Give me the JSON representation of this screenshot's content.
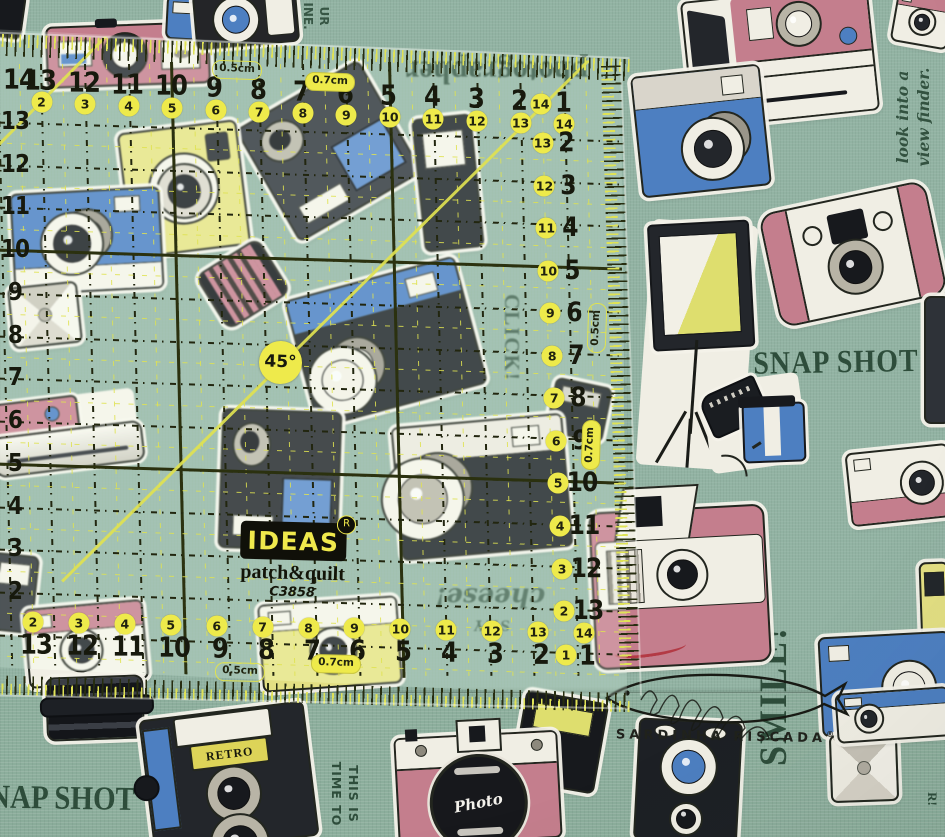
{
  "scene": {
    "subject": "Square transparent quilting ruler lying on sage-green vintage-camera print fabric",
    "photo": true
  },
  "palette": {
    "fabric_green": "#92b3a3",
    "fabric_green_bottom": "#8cae9c",
    "ruler_line_dark": "#2b310f",
    "ruler_dash_black": "#22260f",
    "ruler_accent_yellow": "#dfe250",
    "circle_yellow": "#eeea4b",
    "ink_green": "#2e4d3b",
    "ink_black": "#20221c",
    "sticker_white": "#f1efe6",
    "camera_pink": "#c47e8d",
    "camera_blue": "#4d7fc1",
    "camera_yellow": "#e3df83",
    "camera_dark": "#21242a"
  },
  "ruler": {
    "brand": {
      "name": "IDEAS",
      "reg": "R",
      "line2": "patch&quilt",
      "model": "C3858"
    },
    "angle_label": "45°",
    "labels": {
      "half": "0.5cm",
      "seven": "0.7cm"
    },
    "top_row": [
      {
        "b": "14"
      },
      {
        "b": "13",
        "y": "2"
      },
      {
        "b": "12",
        "y": "3"
      },
      {
        "b": "11",
        "y": "4"
      },
      {
        "b": "10",
        "y": "5"
      },
      {
        "b": "9",
        "y": "6"
      },
      {
        "b": "8",
        "y": "7"
      },
      {
        "b": "7",
        "y": "8"
      },
      {
        "b": "6",
        "y": "9"
      },
      {
        "b": "5",
        "y": "10"
      },
      {
        "b": "4",
        "y": "11"
      },
      {
        "b": "3",
        "y": "12"
      },
      {
        "b": "2",
        "y": "13"
      },
      {
        "b": "1",
        "y": "14"
      }
    ],
    "left_col": [
      "13",
      "12",
      "11",
      "10",
      "9",
      "8",
      "7",
      "6",
      "5",
      "4",
      "3",
      "2"
    ],
    "right_col": [
      {
        "y": "14"
      },
      {
        "b": "2",
        "y": "13"
      },
      {
        "b": "3",
        "y": "12"
      },
      {
        "b": "4",
        "y": "11"
      },
      {
        "b": "5",
        "y": "10"
      },
      {
        "b": "6",
        "y": "9"
      },
      {
        "b": "7",
        "y": "8"
      },
      {
        "b": "8",
        "y": "7"
      },
      {
        "b": "9",
        "y": "6"
      },
      {
        "b": "10",
        "y": "5"
      },
      {
        "b": "11",
        "y": "4"
      },
      {
        "b": "12",
        "y": "3"
      },
      {
        "b": "13",
        "y": "2"
      }
    ],
    "bottom_row": [
      {
        "b": "13",
        "y": "2"
      },
      {
        "b": "12",
        "y": "3"
      },
      {
        "b": "11",
        "y": "4"
      },
      {
        "b": "10",
        "y": "5"
      },
      {
        "b": "9",
        "y": "6"
      },
      {
        "b": "8",
        "y": "7"
      },
      {
        "b": "7",
        "y": "8"
      },
      {
        "b": "6",
        "y": "9"
      },
      {
        "b": "5",
        "y": "10"
      },
      {
        "b": "4",
        "y": "11"
      },
      {
        "b": "3",
        "y": "12"
      },
      {
        "b": "2",
        "y": "13"
      },
      {
        "b": "1",
        "y": "14"
      }
    ],
    "bottom_extra_yellow": "1"
  },
  "fabric_texts": [
    {
      "id": "photographer",
      "lines": [
        "photographer"
      ],
      "x": 497,
      "y": 72,
      "rot": 180,
      "size": 31,
      "cls": "serif",
      "sy": 1.05,
      "op": 0.88
    },
    {
      "id": "top-partial",
      "lines": [
        "UR",
        "INE."
      ],
      "x": 316,
      "y": 16,
      "rot": 90,
      "size": 12,
      "cls": "sans",
      "op": 0.9
    },
    {
      "id": "look-into-viewfinder",
      "lines": [
        "look into a",
        "view finder."
      ],
      "x": 914,
      "y": 117,
      "rot": -90,
      "size": 15.5,
      "cls": "script",
      "op": 0.95
    },
    {
      "id": "snap-shot",
      "lines": [
        "SNAP SHOT"
      ],
      "x": 836,
      "y": 363,
      "rot": -1,
      "size": 28,
      "cls": "serif",
      "sy": 1.15,
      "ls": 1
    },
    {
      "id": "click",
      "lines": [
        "CLICK!"
      ],
      "x": 512,
      "y": 338,
      "rot": 90,
      "size": 21,
      "cls": "serif",
      "ls": 2,
      "op": 0.8
    },
    {
      "id": "lets-take-a-photo",
      "lines": [
        "LET'S TAKE A",
        "PHOTO TOGETHER!"
      ],
      "x": 352,
      "y": 354,
      "rot": 180,
      "size": 11,
      "cls": "serif",
      "op": 0.78
    },
    {
      "id": "say-cheese",
      "lines": [
        "SAY",
        "cheese!"
      ],
      "x": 490,
      "y": 607,
      "rot": 180,
      "size": 16,
      "cls": "script",
      "op": 0.72,
      "big2": 26
    },
    {
      "id": "smile",
      "lines": [
        "SMILE!"
      ],
      "x": 773,
      "y": 696,
      "rot": -90,
      "size": 36,
      "cls": "serif",
      "sy": 1.1,
      "ls": 2
    },
    {
      "id": "this-is-time-to",
      "lines": [
        "THIS IS",
        "TIME TO"
      ],
      "x": 344,
      "y": 794,
      "rot": 90,
      "size": 12.5,
      "cls": "sans",
      "ls": 1
    },
    {
      "id": "nap-shot",
      "lines": [
        "NAP SHOT"
      ],
      "x": 62,
      "y": 799,
      "rot": 1,
      "size": 29,
      "cls": "serif",
      "sy": 1.15
    },
    {
      "id": "partial-r",
      "lines": [
        "R!"
      ],
      "x": 932,
      "y": 799,
      "rot": 90,
      "size": 13,
      "cls": "serif"
    }
  ],
  "stickers": [
    {
      "id": "black-corner-topleft",
      "type": "block",
      "x": -10,
      "y": -8,
      "w": 30,
      "h": 42,
      "rot": 8,
      "body": "#17191d"
    },
    {
      "id": "pink-rangefinder-top",
      "type": "rangefinder",
      "x": 46,
      "y": 24,
      "w": 160,
      "h": 58,
      "rot": -2,
      "body": "#c47e8d"
    },
    {
      "id": "blue-strip-top",
      "type": "block",
      "x": 166,
      "y": -4,
      "w": 36,
      "h": 40,
      "rot": 3,
      "body": "#4d7fc1",
      "band": "#f0eee4"
    },
    {
      "id": "tlr-topview",
      "type": "tlrtop",
      "x": 194,
      "y": -10,
      "w": 100,
      "h": 52,
      "rot": -5
    },
    {
      "id": "white-cam-topright",
      "type": "compact",
      "x": 894,
      "y": -10,
      "w": 54,
      "h": 52,
      "rot": 10,
      "body": "#f0eee4",
      "top": "#c47e8d",
      "lens": "#23262b",
      "lr": 12
    },
    {
      "id": "polaroid-camera",
      "type": "polaroid",
      "x": 686,
      "y": -8,
      "w": 184,
      "h": 124,
      "rot": -6
    },
    {
      "id": "blue-telephoto-cam",
      "type": "tele",
      "x": 636,
      "y": 70,
      "w": 126,
      "h": 118,
      "rot": -6,
      "body": "#4d7fc1",
      "top": "#d9d5cb",
      "lens": "#23262b",
      "lx": 58,
      "ly": 66,
      "lr": 30
    },
    {
      "id": "camcorder-topright",
      "type": "camcorder",
      "x": 258,
      "y": 86,
      "w": 138,
      "h": 126,
      "rot": -30,
      "body": "#34383f"
    },
    {
      "id": "dark-vertical-cam",
      "type": "block",
      "x": 418,
      "y": 116,
      "w": 56,
      "h": 130,
      "rot": -6,
      "body": "#23262b",
      "band": "#f0eee4"
    },
    {
      "id": "yellow-instax",
      "type": "instax",
      "x": 124,
      "y": 126,
      "w": 116,
      "h": 122,
      "rot": -7,
      "body": "#e3df83"
    },
    {
      "id": "blue-compact-left",
      "type": "tele",
      "x": 12,
      "y": 190,
      "w": 146,
      "h": 98,
      "rot": -3,
      "body": "#4d7fc1",
      "base": "#f0eee4",
      "lens": "#1d2025",
      "lx": 40,
      "ly": 52,
      "lr": 30
    },
    {
      "id": "flash-cube-left",
      "type": "flashcube",
      "x": 10,
      "y": 284,
      "w": 66,
      "h": 58,
      "rot": -6
    },
    {
      "id": "film-battery",
      "type": "battery",
      "x": 206,
      "y": 252,
      "w": 70,
      "h": 60,
      "rot": -32,
      "body": "#c47e8d"
    },
    {
      "id": "slr-45-cam",
      "type": "tele",
      "x": 298,
      "y": 276,
      "w": 172,
      "h": 128,
      "rot": -15,
      "body": "#23262b",
      "top": "#4d7fc1",
      "lens": "#efede2",
      "lx": 20,
      "ly": 70,
      "lr": 33
    },
    {
      "id": "topview-cam",
      "type": "topview",
      "x": 768,
      "y": 196,
      "w": 166,
      "h": 112,
      "rot": -12
    },
    {
      "id": "softbox-light",
      "type": "softbox",
      "x": 644,
      "y": 222,
      "w": 106,
      "h": 246,
      "rot": 4
    },
    {
      "id": "film-roll",
      "type": "filmroll",
      "x": 706,
      "y": 378,
      "w": 98,
      "h": 90,
      "rot": -8
    },
    {
      "id": "pink-white-cam-right",
      "type": "compact",
      "x": 848,
      "y": 448,
      "w": 100,
      "h": 70,
      "rot": -6,
      "body": "#f0eee4",
      "bottom": "#c47e8d",
      "lens": "#23262b",
      "lx": 72,
      "ly": 50,
      "lr": 20
    },
    {
      "id": "dark-edge-right",
      "type": "block",
      "x": 924,
      "y": 296,
      "w": 22,
      "h": 124,
      "rot": 0,
      "body": "#2e3238"
    },
    {
      "id": "film-strip-mid",
      "type": "block",
      "x": 550,
      "y": 382,
      "w": 54,
      "h": 52,
      "rot": 12,
      "body": "#23262b",
      "band": "#cfccc2"
    },
    {
      "id": "camcorder-mid",
      "type": "camcorder",
      "x": 220,
      "y": 410,
      "w": 116,
      "h": 136,
      "rot": 2,
      "body": "#26292e"
    },
    {
      "id": "slr-mid-cam",
      "type": "tele",
      "x": 396,
      "y": 420,
      "w": 168,
      "h": 130,
      "rot": -5,
      "body": "#23262b",
      "top": "#e8e4da",
      "lens": "#b8b4a6",
      "lx": 14,
      "ly": 55,
      "lr": 40
    },
    {
      "id": "pink-barrel-left",
      "type": "barrel",
      "x": -8,
      "y": 396,
      "w": 146,
      "h": 74,
      "rot": -7
    },
    {
      "id": "edge-cam-left",
      "type": "block",
      "x": -10,
      "y": 554,
      "w": 42,
      "h": 74,
      "rot": 6,
      "body": "#30343a",
      "band": "#f0eee4"
    },
    {
      "id": "white-cam-bottomleft",
      "type": "compact",
      "x": 26,
      "y": 604,
      "w": 116,
      "h": 76,
      "rot": -5,
      "body": "#f0eee4",
      "top": "#c47e8d",
      "lens": "#23262b",
      "lx": 46,
      "ly": 58,
      "lr": 20
    },
    {
      "id": "yellow-compact-bottom",
      "type": "compact",
      "x": 260,
      "y": 600,
      "w": 136,
      "h": 84,
      "rot": -4,
      "body": "#e3df83",
      "top": "#f0eee4",
      "lens": "#23262b",
      "lx": 52,
      "ly": 58,
      "lr": 22
    },
    {
      "id": "pink-instant-cam",
      "type": "instant",
      "x": 592,
      "y": 508,
      "w": 172,
      "h": 154,
      "rot": -3
    },
    {
      "id": "yellow-cam-right-edge",
      "type": "block",
      "x": 920,
      "y": 562,
      "w": 26,
      "h": 82,
      "rot": -2,
      "body": "#e3df83",
      "band": "#23262b"
    },
    {
      "id": "blue-cam-right",
      "type": "compact",
      "x": 820,
      "y": 634,
      "w": 128,
      "h": 96,
      "rot": -3,
      "body": "#4d7fc1",
      "lens": "#f0eee4",
      "lx": 68,
      "ly": 55,
      "lr": 26
    },
    {
      "id": "lens-below-ruler",
      "type": "barrelv",
      "x": 46,
      "y": 676,
      "w": 94,
      "h": 60,
      "rot": -2
    },
    {
      "id": "retro-tlr-cam",
      "type": "tlr",
      "x": 146,
      "y": 710,
      "w": 162,
      "h": 132,
      "rot": -7,
      "label": "RETRO"
    },
    {
      "id": "black-flash-bottom",
      "type": "block",
      "x": 518,
      "y": 696,
      "w": 80,
      "h": 88,
      "rot": 10,
      "body": "#17191d",
      "band": "#dede6e"
    },
    {
      "id": "pink-photo-slr",
      "type": "slrphoto",
      "x": 396,
      "y": 734,
      "w": 160,
      "h": 104,
      "rot": -3,
      "label": "Photo"
    },
    {
      "id": "black-blue-cam-bottom",
      "type": "darkcam",
      "x": 636,
      "y": 720,
      "w": 100,
      "h": 118,
      "rot": 3
    },
    {
      "id": "flash-cube-bottomright",
      "type": "flashcube",
      "x": 830,
      "y": 734,
      "w": 64,
      "h": 64,
      "rot": -2
    },
    {
      "id": "white-blue-cam-bottomright",
      "type": "compact",
      "x": 836,
      "y": 690,
      "w": 110,
      "h": 46,
      "rot": -4,
      "body": "#f0eee4",
      "top": "#4d7fc1",
      "lens": "#23262b",
      "lx": 28,
      "ly": 55,
      "lr": 13
    }
  ],
  "stamp": {
    "text": "SARDINHA RISCADA",
    "reg": "®",
    "logo": "sardine-fish-scribble"
  }
}
